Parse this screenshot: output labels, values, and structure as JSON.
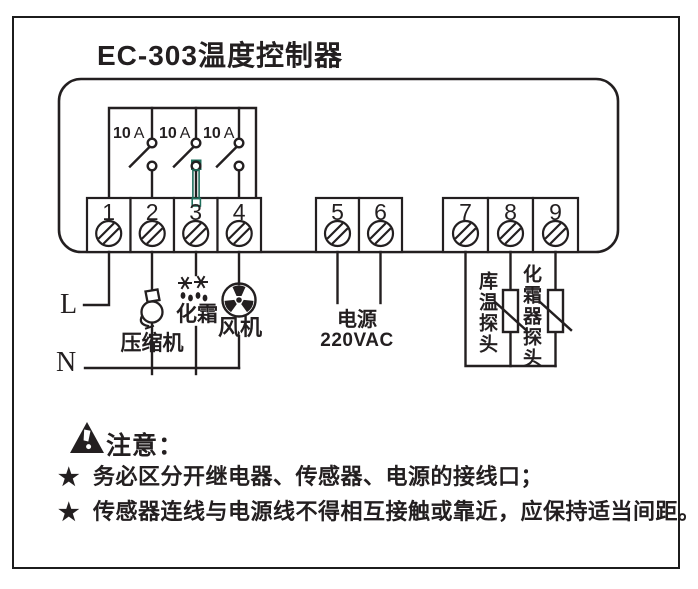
{
  "title": "EC-303温度控制器",
  "colors": {
    "ink": "#231f20",
    "annotation": "#1f6f5c",
    "background": "#ffffff"
  },
  "breakers": [
    {
      "amp": "10",
      "unit": "A"
    },
    {
      "amp": "10",
      "unit": "A"
    },
    {
      "amp": "10",
      "unit": "A"
    }
  ],
  "terminals": [
    "1",
    "2",
    "3",
    "4",
    "5",
    "6",
    "7",
    "8",
    "9"
  ],
  "mains": {
    "live": "L",
    "neutral": "N"
  },
  "loads": {
    "compressor": "压缩机",
    "defrost": "化霜",
    "fan": "风机"
  },
  "supply": {
    "label": "电源",
    "voltage": "220VAC"
  },
  "probes": {
    "room": "库温探头",
    "defroster": "化霜器探头"
  },
  "notice": {
    "heading": "注意：",
    "bullet": "★",
    "items": [
      "务必区分开继电器、传感器、电源的接线口；",
      "传感器连线与电源线不得相互接触或靠近，应保持适当间距。"
    ]
  }
}
